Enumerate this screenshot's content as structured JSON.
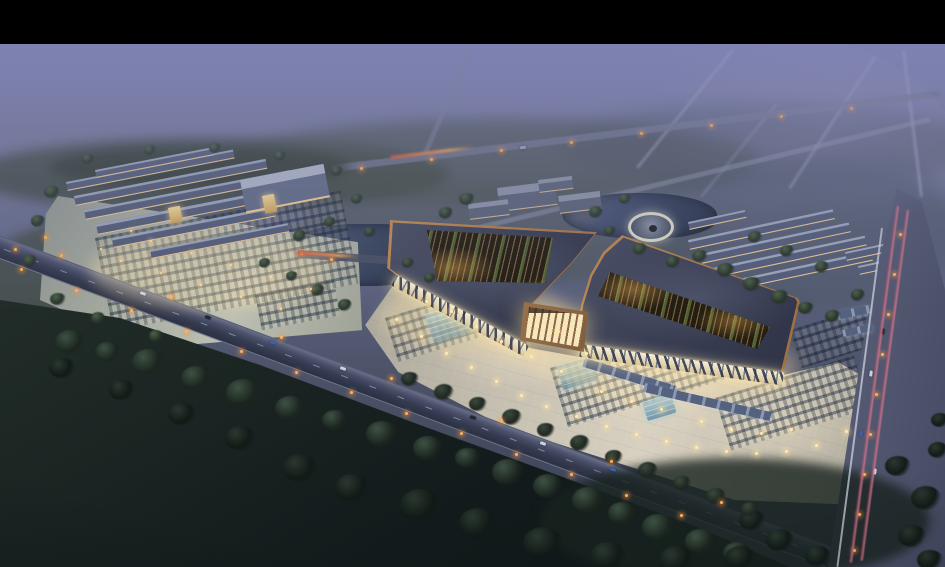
{
  "scene_description": "Aerial dusk rendering of a traditional-style market complex: two copper-trimmed pavilions with open ribbed courtyards and glowing colonnades, central gate, lit plaza with parking rows and pools, left market cluster with parking lot, circular plaza, ponds, row buildings, diagonal avenue, vertical highway with light trails, dark woods foreground, purple fog distance, black letterbox bar on top",
  "palette": {
    "letterbox": "#000000",
    "fog_top": "#7e82b2",
    "fog_mid": "#70749a",
    "horizon_haze": "#5d637f",
    "treeline": "#3f4a41",
    "field_dark": "#16201e",
    "woods": "#22302a",
    "plaza": "#cdc7ba",
    "plaza_glow": "#efe6cf",
    "roof": "#3c4154",
    "roof_trim": "#ad7c4c",
    "courtyard": "#3a2f1f",
    "courtyard_green": "#5a6b3c",
    "colonnade": "#f2e9d2",
    "truss": "#2e3548",
    "pond": "#36425c",
    "road": "#3f4558",
    "highway": "#555a74",
    "trail_pink": "#d68fa4",
    "trail_red": "#c25868",
    "light_warm": "#ffe9b8",
    "light_orange": "#ffb25e",
    "car_blue": "#3a62b0"
  },
  "frame": {
    "top_bar_height": 44
  },
  "trees": [
    [
      70,
      342,
      15,
      "fg"
    ],
    [
      108,
      352,
      13,
      "fg"
    ],
    [
      148,
      362,
      16,
      "fg"
    ],
    [
      196,
      378,
      15,
      "fg"
    ],
    [
      243,
      393,
      17,
      "fg"
    ],
    [
      290,
      408,
      15,
      "fg"
    ],
    [
      335,
      420,
      13,
      "fg"
    ],
    [
      382,
      434,
      16,
      "fg"
    ],
    [
      428,
      448,
      15,
      "fg"
    ],
    [
      468,
      458,
      13,
      "fg"
    ],
    [
      508,
      472,
      16,
      "fg"
    ],
    [
      548,
      486,
      15,
      "fg"
    ],
    [
      588,
      500,
      16,
      "fg"
    ],
    [
      622,
      513,
      14,
      "fg"
    ],
    [
      658,
      527,
      16,
      "fg"
    ],
    [
      700,
      541,
      15,
      "fg"
    ],
    [
      737,
      553,
      14,
      "fg"
    ],
    [
      420,
      505,
      20,
      "dark"
    ],
    [
      478,
      523,
      19,
      "dark"
    ],
    [
      543,
      543,
      20,
      "dark"
    ],
    [
      608,
      556,
      18,
      "dark"
    ],
    [
      676,
      560,
      17,
      "dark"
    ],
    [
      740,
      558,
      15,
      "dark"
    ],
    [
      300,
      468,
      17,
      "dark"
    ],
    [
      352,
      488,
      17,
      "dark"
    ],
    [
      240,
      438,
      15,
      "dark"
    ],
    [
      182,
      414,
      14,
      "dark"
    ],
    [
      122,
      390,
      13,
      "dark"
    ],
    [
      62,
      368,
      13,
      "dark"
    ],
    [
      780,
      540,
      14,
      "dark"
    ],
    [
      818,
      556,
      13,
      "dark"
    ],
    [
      752,
      520,
      13,
      "dark"
    ],
    [
      410,
      379,
      9,
      "mid"
    ],
    [
      444,
      392,
      10,
      "mid"
    ],
    [
      478,
      404,
      9,
      "mid"
    ],
    [
      512,
      417,
      10,
      "mid"
    ],
    [
      546,
      430,
      9,
      "mid"
    ],
    [
      580,
      443,
      10,
      "mid"
    ],
    [
      614,
      457,
      9,
      "mid"
    ],
    [
      648,
      470,
      10,
      "mid"
    ],
    [
      682,
      483,
      9,
      "mid"
    ],
    [
      716,
      496,
      10,
      "mid"
    ],
    [
      750,
      509,
      9,
      "mid"
    ],
    [
      898,
      466,
      13,
      "dark"
    ],
    [
      926,
      498,
      15,
      "dark"
    ],
    [
      912,
      536,
      14,
      "dark"
    ],
    [
      938,
      450,
      10,
      "dark"
    ],
    [
      930,
      560,
      13,
      "dark"
    ],
    [
      940,
      420,
      9,
      "dark"
    ],
    [
      467,
      199,
      8,
      "lush"
    ],
    [
      446,
      213,
      7,
      "lush"
    ],
    [
      596,
      212,
      7,
      "lush"
    ],
    [
      625,
      199,
      6,
      "lush"
    ],
    [
      700,
      256,
      8,
      "lush"
    ],
    [
      726,
      270,
      9,
      "lush"
    ],
    [
      752,
      284,
      9,
      "lush"
    ],
    [
      780,
      297,
      9,
      "lush"
    ],
    [
      806,
      308,
      8,
      "lush"
    ],
    [
      833,
      316,
      8,
      "lush"
    ],
    [
      858,
      295,
      7,
      "lush"
    ],
    [
      822,
      267,
      7,
      "lush"
    ],
    [
      787,
      251,
      7,
      "lush"
    ],
    [
      755,
      237,
      7,
      "lush"
    ],
    [
      640,
      249,
      7,
      "lush"
    ],
    [
      610,
      231,
      6,
      "lush"
    ],
    [
      673,
      262,
      7,
      "lush"
    ],
    [
      52,
      192,
      8,
      "lush"
    ],
    [
      38,
      221,
      7,
      "lush"
    ],
    [
      88,
      159,
      6,
      "lush"
    ],
    [
      150,
      150,
      6,
      "lush"
    ],
    [
      215,
      148,
      6,
      "lush"
    ],
    [
      280,
      156,
      6,
      "lush"
    ],
    [
      337,
      171,
      6,
      "lush"
    ],
    [
      357,
      199,
      6,
      "lush"
    ],
    [
      30,
      261,
      7,
      "lush"
    ],
    [
      58,
      299,
      8,
      "lush"
    ],
    [
      98,
      318,
      7,
      "lush"
    ],
    [
      156,
      336,
      7,
      "lush"
    ],
    [
      345,
      305,
      7,
      "lush"
    ],
    [
      318,
      290,
      7,
      "lush"
    ],
    [
      292,
      276,
      6,
      "lush"
    ],
    [
      265,
      263,
      6,
      "lush"
    ],
    [
      300,
      236,
      7,
      "lush"
    ],
    [
      330,
      222,
      6,
      "lush"
    ],
    [
      370,
      232,
      6,
      "lush"
    ],
    [
      408,
      263,
      6,
      "lush"
    ],
    [
      430,
      278,
      6,
      "lush"
    ]
  ],
  "street_lights": [
    [
      20,
      268
    ],
    [
      75,
      289
    ],
    [
      130,
      309
    ],
    [
      185,
      330
    ],
    [
      240,
      350
    ],
    [
      295,
      371
    ],
    [
      350,
      391
    ],
    [
      405,
      412
    ],
    [
      460,
      432
    ],
    [
      515,
      453
    ],
    [
      570,
      473
    ],
    [
      625,
      494
    ],
    [
      680,
      514
    ],
    [
      60,
      254
    ],
    [
      170,
      295
    ],
    [
      280,
      336
    ],
    [
      390,
      377
    ],
    [
      500,
      419
    ],
    [
      610,
      460
    ],
    [
      720,
      501
    ],
    [
      899,
      233
    ],
    [
      893,
      273
    ],
    [
      887,
      313
    ],
    [
      881,
      353
    ],
    [
      875,
      393
    ],
    [
      869,
      433
    ],
    [
      863,
      473
    ],
    [
      858,
      513
    ],
    [
      853,
      549
    ],
    [
      360,
      167
    ],
    [
      430,
      158
    ],
    [
      500,
      149
    ],
    [
      570,
      141
    ],
    [
      640,
      132
    ],
    [
      710,
      124
    ],
    [
      780,
      115
    ],
    [
      850,
      107
    ],
    [
      14,
      248
    ],
    [
      44,
      236
    ],
    [
      330,
      258
    ],
    [
      300,
      252
    ]
  ],
  "plaza_lights": [
    [
      395,
      318
    ],
    [
      420,
      335
    ],
    [
      445,
      352
    ],
    [
      470,
      366
    ],
    [
      495,
      380
    ],
    [
      520,
      394
    ],
    [
      545,
      405
    ],
    [
      575,
      415
    ],
    [
      605,
      425
    ],
    [
      635,
      433
    ],
    [
      665,
      440
    ],
    [
      695,
      446
    ],
    [
      725,
      450
    ],
    [
      755,
      452
    ],
    [
      785,
      450
    ],
    [
      815,
      444
    ],
    [
      845,
      430
    ],
    [
      600,
      390
    ],
    [
      630,
      400
    ],
    [
      660,
      408
    ],
    [
      560,
      370
    ],
    [
      530,
      355
    ],
    [
      500,
      340
    ],
    [
      475,
      325
    ],
    [
      450,
      310
    ],
    [
      425,
      300
    ],
    [
      700,
      420
    ],
    [
      730,
      428
    ],
    [
      760,
      432
    ],
    [
      790,
      428
    ],
    [
      557,
      330
    ],
    [
      585,
      352
    ]
  ],
  "complex_lights": [
    [
      120,
      260
    ],
    [
      160,
      272
    ],
    [
      200,
      284
    ],
    [
      240,
      296
    ],
    [
      280,
      308
    ],
    [
      150,
      240
    ],
    [
      190,
      252
    ],
    [
      230,
      264
    ],
    [
      270,
      276
    ],
    [
      310,
      288
    ],
    [
      100,
      248
    ],
    [
      130,
      230
    ]
  ],
  "cars": [
    [
      140,
      292,
      20,
      "#c9d2de"
    ],
    [
      205,
      316,
      20,
      "#22262e"
    ],
    [
      270,
      341,
      20,
      "#3a62b0"
    ],
    [
      340,
      367,
      20,
      "#c9d2de"
    ],
    [
      470,
      416,
      20,
      "#22262e"
    ],
    [
      540,
      442,
      20,
      "#c9d2de"
    ],
    [
      610,
      468,
      20,
      "#3a62b0"
    ],
    [
      868,
      372,
      97,
      "#c9d2de"
    ],
    [
      880,
      330,
      97,
      "#22262e"
    ],
    [
      858,
      432,
      97,
      "#3a62b0"
    ],
    [
      872,
      470,
      97,
      "#c9d2de"
    ],
    [
      520,
      146,
      -7,
      "#9aa2b4"
    ]
  ],
  "left_buildings": [
    [
      66,
      182,
      170,
      9,
      -11,
      "std"
    ],
    [
      74,
      196,
      195,
      10,
      -11,
      "std"
    ],
    [
      84,
      210,
      210,
      10,
      -11,
      "std"
    ],
    [
      96,
      224,
      195,
      11,
      -11,
      "std"
    ],
    [
      112,
      238,
      165,
      10,
      -11,
      "std"
    ],
    [
      150,
      250,
      140,
      9,
      -11,
      "std"
    ],
    [
      240,
      180,
      85,
      34,
      -11,
      "big"
    ],
    [
      95,
      170,
      120,
      8,
      -11,
      "std"
    ],
    [
      168,
      208,
      12,
      16,
      -11,
      "lit"
    ],
    [
      262,
      196,
      12,
      18,
      -11,
      "lit"
    ]
  ],
  "right_buildings": [
    [
      688,
      240,
      148,
      10,
      -12,
      "std"
    ],
    [
      700,
      254,
      152,
      10,
      -12,
      "std"
    ],
    [
      712,
      268,
      156,
      10,
      -12,
      "std"
    ],
    [
      724,
      282,
      150,
      10,
      -12,
      "std"
    ],
    [
      688,
      222,
      58,
      8,
      -12,
      "std"
    ],
    [
      845,
      252,
      62,
      9,
      -12,
      "std"
    ],
    [
      858,
      266,
      58,
      9,
      -12,
      "std"
    ]
  ],
  "hotel_buildings": [
    [
      497,
      188,
      58,
      24,
      -7,
      "hot"
    ],
    [
      468,
      204,
      40,
      16,
      -7,
      "hot"
    ],
    [
      538,
      180,
      34,
      13,
      -7,
      "hot"
    ],
    [
      558,
      196,
      42,
      18,
      -7,
      "hot"
    ]
  ],
  "parking_groups": [
    [
      385,
      318,
      135,
      46,
      -17
    ],
    [
      550,
      368,
      175,
      62,
      -17
    ],
    [
      715,
      398,
      145,
      55,
      -17
    ],
    [
      790,
      330,
      85,
      40,
      -17
    ],
    [
      95,
      238,
      250,
      95,
      -11
    ],
    [
      255,
      295,
      80,
      36,
      -11
    ]
  ],
  "pools": [
    [
      425,
      314,
      75,
      30,
      -17
    ],
    [
      556,
      366,
      36,
      26,
      -17
    ],
    [
      642,
      402,
      30,
      20,
      -17
    ]
  ],
  "distant_roads": [
    [
      636,
      167,
      152,
      -51,
      0.5
    ],
    [
      788,
      188,
      158,
      -57,
      0.45
    ],
    [
      700,
      196,
      120,
      -51,
      0.28
    ],
    [
      905,
      50,
      148,
      83,
      0.55
    ]
  ],
  "light_trails": [
    [
      390,
      156,
      85,
      -7,
      "red"
    ],
    [
      296,
      251,
      62,
      4,
      "red"
    ],
    [
      899,
      206,
      360,
      97.5,
      "pink"
    ],
    [
      909,
      210,
      354,
      97.5,
      "pink"
    ],
    [
      883,
      228,
      342,
      97.5,
      "white"
    ]
  ],
  "canopies": [
    [
      585,
      358,
      95,
      9,
      17
    ],
    [
      645,
      383,
      130,
      9,
      13
    ],
    [
      836,
      312,
      34,
      8,
      -12
    ],
    [
      842,
      330,
      30,
      7,
      -12
    ]
  ],
  "glow_patches": [
    [
      380,
      282,
      190,
      70
    ],
    [
      560,
      330,
      240,
      75
    ],
    [
      525,
      315,
      95,
      70
    ],
    [
      90,
      230,
      240,
      80
    ]
  ]
}
